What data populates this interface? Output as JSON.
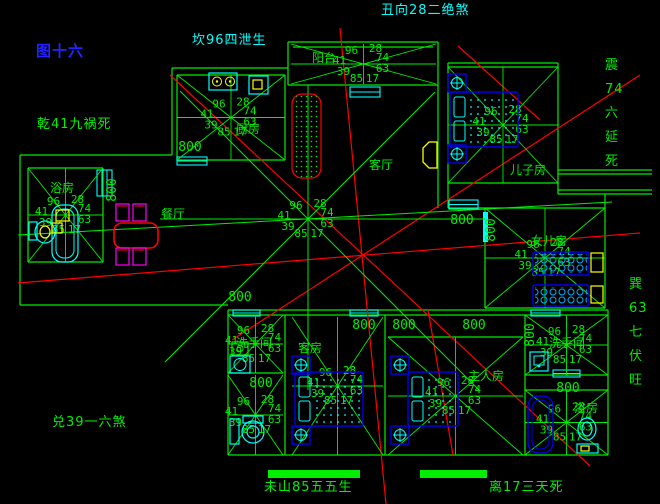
{
  "figure_label": "图十六",
  "compass": {
    "facing_top": "丑向28二绝煞",
    "kan": "坎96四泄生",
    "qian": "乾41九祸死",
    "zhen_lines": [
      "震",
      "74",
      "六",
      "延",
      "死"
    ],
    "xun_lines": [
      "巽",
      "63",
      "七",
      "伏",
      "旺"
    ],
    "dui": "兑39一六煞",
    "mountain_left": "未山85五五生",
    "li_right": "离17三天死"
  },
  "flying_star": {
    "top_left": "96",
    "top_right": "28",
    "mid_left": "41",
    "mid_right": "74",
    "low_left": "39",
    "low_right": "63",
    "bottom_left": "85",
    "bottom_right": "17"
  },
  "rooms": [
    {
      "id": "kitchen",
      "label": "厨房"
    },
    {
      "id": "balcony",
      "label": "阳台"
    },
    {
      "id": "living",
      "label": "客厅"
    },
    {
      "id": "dining",
      "label": "餐厅"
    },
    {
      "id": "bath-left",
      "label": "浴房"
    },
    {
      "id": "son-room",
      "label": "儿子房"
    },
    {
      "id": "daughter-room",
      "label": "女儿房"
    },
    {
      "id": "guest-room",
      "label": "客房"
    },
    {
      "id": "master-room",
      "label": "主人房"
    },
    {
      "id": "washroom-left",
      "label": "洗手间"
    },
    {
      "id": "washroom-right",
      "label": "洗手间"
    },
    {
      "id": "bath-right",
      "label": "浴房"
    }
  ],
  "dimension_label": "800",
  "colors": {
    "wall": "#00ee00",
    "fixture": "#00ffff",
    "furniture": "#0000ee",
    "analysis": "#ff0000",
    "chair": "#ff00ff",
    "highlight": "#ffff00",
    "figure": "#2323ff",
    "title": "#00ffff"
  }
}
